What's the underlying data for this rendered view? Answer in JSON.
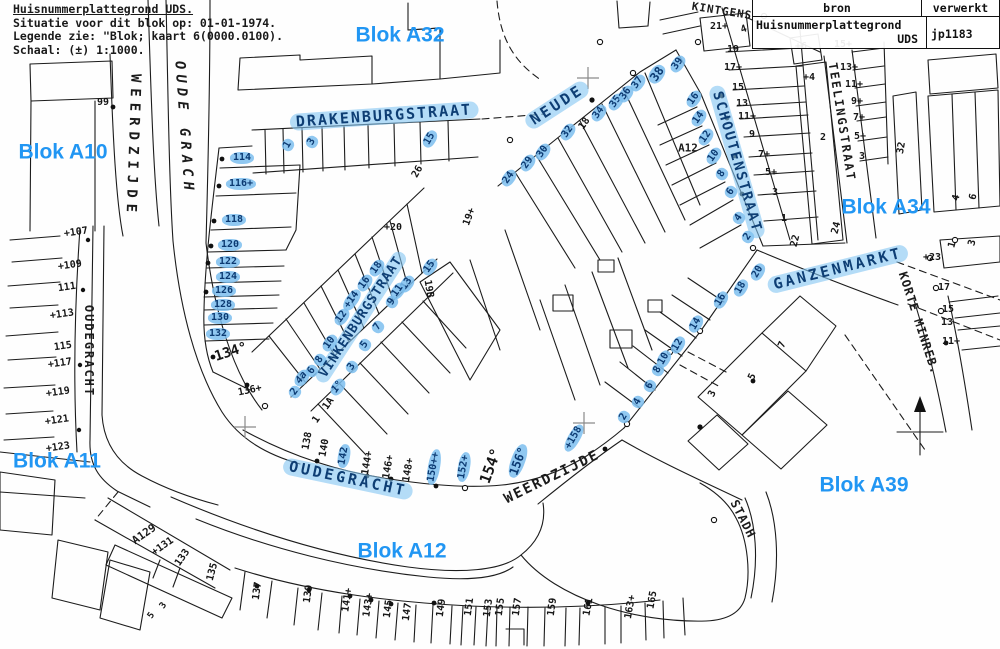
{
  "header": {
    "lines": [
      "Huisnummerplattegrond UDS.",
      "Situatie voor dit blok op: 01-01-1974.",
      "Legende zie: \"Blok; kaart 6(0000.0100).",
      "Schaal: (±) 1:1000."
    ]
  },
  "info_table": {
    "col1_header": "bron",
    "col2_header": "verwerkt",
    "source_name": "Huisnummerplattegrond",
    "source_abbr": "UDS",
    "processed_value": "jp1183"
  },
  "colors": {
    "blok_label_blue": "#2196f3",
    "highlight_fill": "#7cbeee",
    "highlight_text": "#0c3a72",
    "ink": "#1c1c1c"
  },
  "map": {
    "blok_labels": [
      {
        "text": "Blok A32",
        "x": 400,
        "y": 35
      },
      {
        "text": "Blok A10",
        "x": 63,
        "y": 152
      },
      {
        "text": "Blok A34",
        "x": 886,
        "y": 207
      },
      {
        "text": "Blok A11",
        "x": 57,
        "y": 461
      },
      {
        "text": "Blok A39",
        "x": 864,
        "y": 485
      },
      {
        "text": "Blok A12",
        "x": 402,
        "y": 551
      }
    ],
    "street_labels": [
      {
        "text": "WEERDZIJDE",
        "x": 133,
        "y": 146,
        "rot": 92,
        "size": 14,
        "sp": 6
      },
      {
        "text": "OUDE GRACH",
        "x": 184,
        "y": 128,
        "rot": 86,
        "size": 14,
        "sp": 5,
        "italic": true
      },
      {
        "text": "DRAKENBURGSTRAAT",
        "x": 384,
        "y": 116,
        "rot": -4,
        "size": 15,
        "sp": 2,
        "hl": true
      },
      {
        "text": "NEUDE",
        "x": 557,
        "y": 105,
        "rot": -33,
        "size": 15,
        "sp": 3,
        "hl": true
      },
      {
        "text": "KINTGENS",
        "x": 722,
        "y": 11,
        "rot": 9,
        "size": 11,
        "sp": 1
      },
      {
        "text": "SCHOUTENSTRAAT",
        "x": 737,
        "y": 162,
        "rot": 74,
        "size": 14,
        "sp": 2,
        "hl": true
      },
      {
        "text": "TEELINGSTRAAT",
        "x": 842,
        "y": 122,
        "rot": 81,
        "size": 12,
        "sp": 2
      },
      {
        "text": "GANZENMARKT",
        "x": 838,
        "y": 269,
        "rot": -14,
        "size": 15,
        "sp": 3,
        "hl": true
      },
      {
        "text": "KORTE MINREB.",
        "x": 919,
        "y": 323,
        "rot": 72,
        "size": 12,
        "sp": 1
      },
      {
        "text": "OUDEGRACHT",
        "x": 89,
        "y": 351,
        "rot": 90,
        "size": 12,
        "sp": 2
      },
      {
        "text": "VINKENBURGSTRAAT",
        "x": 361,
        "y": 317,
        "rot": -57,
        "size": 13,
        "sp": 1,
        "hl": true
      },
      {
        "text": "OUDEGRACHT",
        "x": 348,
        "y": 479,
        "rot": 12,
        "size": 15,
        "sp": 3,
        "hl": true
      },
      {
        "text": "WEERDZIJDE",
        "x": 552,
        "y": 477,
        "rot": -26,
        "size": 14,
        "sp": 2
      },
      {
        "text": "STADH",
        "x": 743,
        "y": 519,
        "rot": 63,
        "size": 12,
        "sp": 1
      },
      {
        "text": "A12",
        "x": 688,
        "y": 148,
        "rot": 0,
        "size": 11,
        "sp": 0
      },
      {
        "text": "A129",
        "x": 144,
        "y": 534,
        "rot": -35,
        "size": 11,
        "sp": 0
      }
    ],
    "house_numbers": [
      {
        "n": "99",
        "x": 103,
        "y": 103
      },
      {
        "n": "114",
        "x": 242,
        "y": 158,
        "hl": 1
      },
      {
        "n": "116+",
        "x": 241,
        "y": 184,
        "hl": 1
      },
      {
        "n": "118",
        "x": 234,
        "y": 220,
        "hl": 1
      },
      {
        "n": "120",
        "x": 230,
        "y": 245,
        "hl": 1
      },
      {
        "n": "122",
        "x": 228,
        "y": 262,
        "hl": 1
      },
      {
        "n": "124",
        "x": 228,
        "y": 277,
        "hl": 1
      },
      {
        "n": "126",
        "x": 224,
        "y": 291,
        "hl": 1
      },
      {
        "n": "128",
        "x": 223,
        "y": 305,
        "hl": 1
      },
      {
        "n": "130",
        "x": 220,
        "y": 318,
        "hl": 1
      },
      {
        "n": "132",
        "x": 218,
        "y": 334,
        "hl": 1
      },
      {
        "n": "134°",
        "x": 231,
        "y": 352,
        "r": -18,
        "s": 14
      },
      {
        "n": "136+",
        "x": 250,
        "y": 391,
        "r": -12
      },
      {
        "n": "+107",
        "x": 76,
        "y": 233,
        "r": -8
      },
      {
        "n": "+109",
        "x": 70,
        "y": 266,
        "r": -8
      },
      {
        "n": "111",
        "x": 67,
        "y": 288,
        "r": -8
      },
      {
        "n": "+113",
        "x": 62,
        "y": 315,
        "r": -8
      },
      {
        "n": "115",
        "x": 63,
        "y": 347,
        "r": -8
      },
      {
        "n": "+117",
        "x": 60,
        "y": 364,
        "r": -8
      },
      {
        "n": "+119",
        "x": 58,
        "y": 393,
        "r": -8
      },
      {
        "n": "+121",
        "x": 57,
        "y": 421,
        "r": -8
      },
      {
        "n": "+123",
        "x": 58,
        "y": 448,
        "r": -8
      },
      {
        "n": "1",
        "x": 288,
        "y": 145,
        "r": -60,
        "hl": 1
      },
      {
        "n": "3",
        "x": 312,
        "y": 142,
        "r": -60,
        "hl": 1
      },
      {
        "n": "15",
        "x": 430,
        "y": 139,
        "r": -60,
        "hl": 1
      },
      {
        "n": "26",
        "x": 418,
        "y": 172,
        "r": -60
      },
      {
        "n": "+20",
        "x": 393,
        "y": 228
      },
      {
        "n": "19+",
        "x": 470,
        "y": 217,
        "r": -70
      },
      {
        "n": "21+",
        "x": 719,
        "y": 27
      },
      {
        "n": "4",
        "x": 744,
        "y": 30,
        "r": -20
      },
      {
        "n": "24",
        "x": 509,
        "y": 178,
        "r": -55,
        "hl": 1
      },
      {
        "n": "29",
        "x": 528,
        "y": 163,
        "r": -55,
        "hl": 1
      },
      {
        "n": "30",
        "x": 543,
        "y": 152,
        "r": -55,
        "hl": 1
      },
      {
        "n": "32",
        "x": 568,
        "y": 132,
        "r": -55,
        "hl": 1
      },
      {
        "n": "18",
        "x": 585,
        "y": 124,
        "r": -55
      },
      {
        "n": "34",
        "x": 599,
        "y": 113,
        "r": -55,
        "hl": 1
      },
      {
        "n": "35",
        "x": 616,
        "y": 102,
        "r": -55,
        "hl": 1
      },
      {
        "n": "36",
        "x": 626,
        "y": 94,
        "r": -55,
        "hl": 1
      },
      {
        "n": "37",
        "x": 638,
        "y": 83,
        "r": -55,
        "hl": 1
      },
      {
        "n": "38",
        "x": 657,
        "y": 74,
        "r": -55,
        "hl": 1,
        "s": 12
      },
      {
        "n": "39",
        "x": 678,
        "y": 64,
        "r": -55,
        "hl": 1
      },
      {
        "n": "16",
        "x": 694,
        "y": 99,
        "r": -55,
        "hl": 1
      },
      {
        "n": "14",
        "x": 699,
        "y": 118,
        "r": -55,
        "hl": 1
      },
      {
        "n": "12",
        "x": 706,
        "y": 137,
        "r": -55,
        "hl": 1
      },
      {
        "n": "10",
        "x": 714,
        "y": 156,
        "r": -55,
        "hl": 1
      },
      {
        "n": "8",
        "x": 722,
        "y": 174,
        "r": -55,
        "hl": 1
      },
      {
        "n": "6",
        "x": 731,
        "y": 192,
        "r": -55,
        "hl": 1
      },
      {
        "n": "4",
        "x": 739,
        "y": 218,
        "r": -55,
        "hl": 1
      },
      {
        "n": "2",
        "x": 748,
        "y": 237,
        "r": -55,
        "hl": 1
      },
      {
        "n": "19",
        "x": 733,
        "y": 50
      },
      {
        "n": "17+",
        "x": 733,
        "y": 68
      },
      {
        "n": "15",
        "x": 738,
        "y": 88
      },
      {
        "n": "13",
        "x": 742,
        "y": 104
      },
      {
        "n": "11+",
        "x": 747,
        "y": 117
      },
      {
        "n": "9",
        "x": 752,
        "y": 135
      },
      {
        "n": "7+",
        "x": 764,
        "y": 155
      },
      {
        "n": "5+",
        "x": 771,
        "y": 173
      },
      {
        "n": "3",
        "x": 775,
        "y": 193
      },
      {
        "n": "1",
        "x": 784,
        "y": 219
      },
      {
        "n": "22",
        "x": 796,
        "y": 241,
        "r": -75
      },
      {
        "n": "+6",
        "x": 801,
        "y": 47
      },
      {
        "n": "+4",
        "x": 809,
        "y": 78
      },
      {
        "n": "2",
        "x": 823,
        "y": 138
      },
      {
        "n": "15+",
        "x": 843,
        "y": 45
      },
      {
        "n": "13+",
        "x": 849,
        "y": 68
      },
      {
        "n": "11+",
        "x": 854,
        "y": 85
      },
      {
        "n": "9+",
        "x": 857,
        "y": 102
      },
      {
        "n": "7+",
        "x": 859,
        "y": 118
      },
      {
        "n": "5+",
        "x": 860,
        "y": 137
      },
      {
        "n": "3",
        "x": 862,
        "y": 157
      },
      {
        "n": "24",
        "x": 837,
        "y": 228,
        "r": -75
      },
      {
        "n": "32",
        "x": 902,
        "y": 148,
        "r": -80
      },
      {
        "n": "4",
        "x": 957,
        "y": 198,
        "r": -75
      },
      {
        "n": "6",
        "x": 974,
        "y": 197,
        "r": -75
      },
      {
        "n": "1",
        "x": 953,
        "y": 245,
        "r": -75
      },
      {
        "n": "3",
        "x": 973,
        "y": 243,
        "r": -75
      },
      {
        "n": "+23",
        "x": 932,
        "y": 258
      },
      {
        "n": "17",
        "x": 944,
        "y": 288
      },
      {
        "n": "15",
        "x": 948,
        "y": 310
      },
      {
        "n": "13",
        "x": 947,
        "y": 323
      },
      {
        "n": "11+",
        "x": 951,
        "y": 342
      },
      {
        "n": "20",
        "x": 758,
        "y": 272,
        "r": -60,
        "hl": 1
      },
      {
        "n": "18",
        "x": 741,
        "y": 288,
        "r": -60,
        "hl": 1
      },
      {
        "n": "16",
        "x": 721,
        "y": 300,
        "r": -60,
        "hl": 1
      },
      {
        "n": "14",
        "x": 696,
        "y": 324,
        "r": -60,
        "hl": 1
      },
      {
        "n": "12",
        "x": 678,
        "y": 345,
        "r": -60,
        "hl": 1
      },
      {
        "n": "10",
        "x": 664,
        "y": 359,
        "r": -60,
        "hl": 1
      },
      {
        "n": "8",
        "x": 658,
        "y": 370,
        "r": -60,
        "hl": 1
      },
      {
        "n": "6",
        "x": 650,
        "y": 386,
        "r": -60,
        "hl": 1
      },
      {
        "n": "4",
        "x": 638,
        "y": 402,
        "r": -60,
        "hl": 1
      },
      {
        "n": "2",
        "x": 624,
        "y": 417,
        "r": -60,
        "hl": 1
      },
      {
        "n": "7",
        "x": 783,
        "y": 345,
        "r": -65
      },
      {
        "n": "5",
        "x": 753,
        "y": 377,
        "r": -65
      },
      {
        "n": "3",
        "x": 713,
        "y": 394,
        "r": -65
      },
      {
        "n": "+158",
        "x": 574,
        "y": 438,
        "r": -60,
        "hl": 1
      },
      {
        "n": "156°",
        "x": 518,
        "y": 461,
        "r": -70,
        "hl": 1,
        "s": 12
      },
      {
        "n": "154°",
        "x": 491,
        "y": 466,
        "r": -70,
        "s": 15
      },
      {
        "n": "152+",
        "x": 464,
        "y": 467,
        "r": -80,
        "hl": 1
      },
      {
        "n": "150++",
        "x": 434,
        "y": 467,
        "r": -80,
        "hl": 1
      },
      {
        "n": "148+",
        "x": 409,
        "y": 470,
        "r": -80
      },
      {
        "n": "146+",
        "x": 389,
        "y": 467,
        "r": -80
      },
      {
        "n": "144+",
        "x": 368,
        "y": 463,
        "r": -80
      },
      {
        "n": "142",
        "x": 344,
        "y": 456,
        "r": -80,
        "hl": 1
      },
      {
        "n": "140",
        "x": 325,
        "y": 448,
        "r": -80
      },
      {
        "n": "138",
        "x": 308,
        "y": 441,
        "r": -80
      },
      {
        "n": "18",
        "x": 377,
        "y": 268,
        "r": -55,
        "hl": 1
      },
      {
        "n": "16",
        "x": 365,
        "y": 283,
        "r": -55,
        "hl": 1
      },
      {
        "n": "+14",
        "x": 352,
        "y": 300,
        "r": -55,
        "hl": 1
      },
      {
        "n": "12",
        "x": 342,
        "y": 317,
        "r": -55,
        "hl": 1
      },
      {
        "n": "10",
        "x": 330,
        "y": 343,
        "r": -55,
        "hl": 1
      },
      {
        "n": "8",
        "x": 320,
        "y": 360,
        "r": -55,
        "hl": 1
      },
      {
        "n": "6",
        "x": 312,
        "y": 371,
        "r": -55,
        "hl": 1
      },
      {
        "n": "4a",
        "x": 302,
        "y": 378,
        "r": -55,
        "hl": 1,
        "i": 1
      },
      {
        "n": "2",
        "x": 295,
        "y": 392,
        "r": -55,
        "hl": 1
      },
      {
        "n": "15",
        "x": 430,
        "y": 267,
        "r": -55,
        "hl": 1
      },
      {
        "n": "13",
        "x": 407,
        "y": 284,
        "r": -55,
        "hl": 1
      },
      {
        "n": "11",
        "x": 398,
        "y": 291,
        "r": -55,
        "hl": 1
      },
      {
        "n": "9",
        "x": 392,
        "y": 302,
        "r": -55,
        "hl": 1
      },
      {
        "n": "7",
        "x": 378,
        "y": 327,
        "r": -55,
        "hl": 1
      },
      {
        "n": "5",
        "x": 365,
        "y": 345,
        "r": -55,
        "hl": 1
      },
      {
        "n": "3",
        "x": 352,
        "y": 367,
        "r": -55,
        "hl": 1
      },
      {
        "n": "1°",
        "x": 338,
        "y": 387,
        "r": -55,
        "hl": 1,
        "i": 1
      },
      {
        "n": "1A",
        "x": 329,
        "y": 404,
        "r": -55
      },
      {
        "n": "1",
        "x": 317,
        "y": 420,
        "r": -55
      },
      {
        "n": "19B",
        "x": 428,
        "y": 289,
        "r": 80
      },
      {
        "n": "+131",
        "x": 163,
        "y": 547,
        "r": -35
      },
      {
        "n": "133",
        "x": 183,
        "y": 558,
        "r": -55
      },
      {
        "n": "3",
        "x": 164,
        "y": 606,
        "r": -55,
        "s": 9
      },
      {
        "n": "5",
        "x": 152,
        "y": 616,
        "r": -55,
        "s": 9
      },
      {
        "n": "135",
        "x": 213,
        "y": 572,
        "r": -75
      },
      {
        "n": "137",
        "x": 258,
        "y": 591,
        "r": -82
      },
      {
        "n": "139",
        "x": 309,
        "y": 594,
        "r": -82
      },
      {
        "n": "141+",
        "x": 348,
        "y": 600,
        "r": -82
      },
      {
        "n": "143+",
        "x": 369,
        "y": 605,
        "r": -82
      },
      {
        "n": "145",
        "x": 389,
        "y": 609,
        "r": -82
      },
      {
        "n": "147",
        "x": 408,
        "y": 612,
        "r": -82
      },
      {
        "n": "149",
        "x": 442,
        "y": 608,
        "r": -82
      },
      {
        "n": "151",
        "x": 470,
        "y": 607,
        "r": -82
      },
      {
        "n": "153",
        "x": 489,
        "y": 608,
        "r": -82
      },
      {
        "n": "155",
        "x": 501,
        "y": 607,
        "r": -82
      },
      {
        "n": "157",
        "x": 518,
        "y": 607,
        "r": -82
      },
      {
        "n": "159",
        "x": 553,
        "y": 607,
        "r": -82
      },
      {
        "n": "161",
        "x": 589,
        "y": 607,
        "r": -80
      },
      {
        "n": "163+",
        "x": 631,
        "y": 607,
        "r": -80
      },
      {
        "n": "165",
        "x": 653,
        "y": 600,
        "r": -80
      }
    ]
  }
}
